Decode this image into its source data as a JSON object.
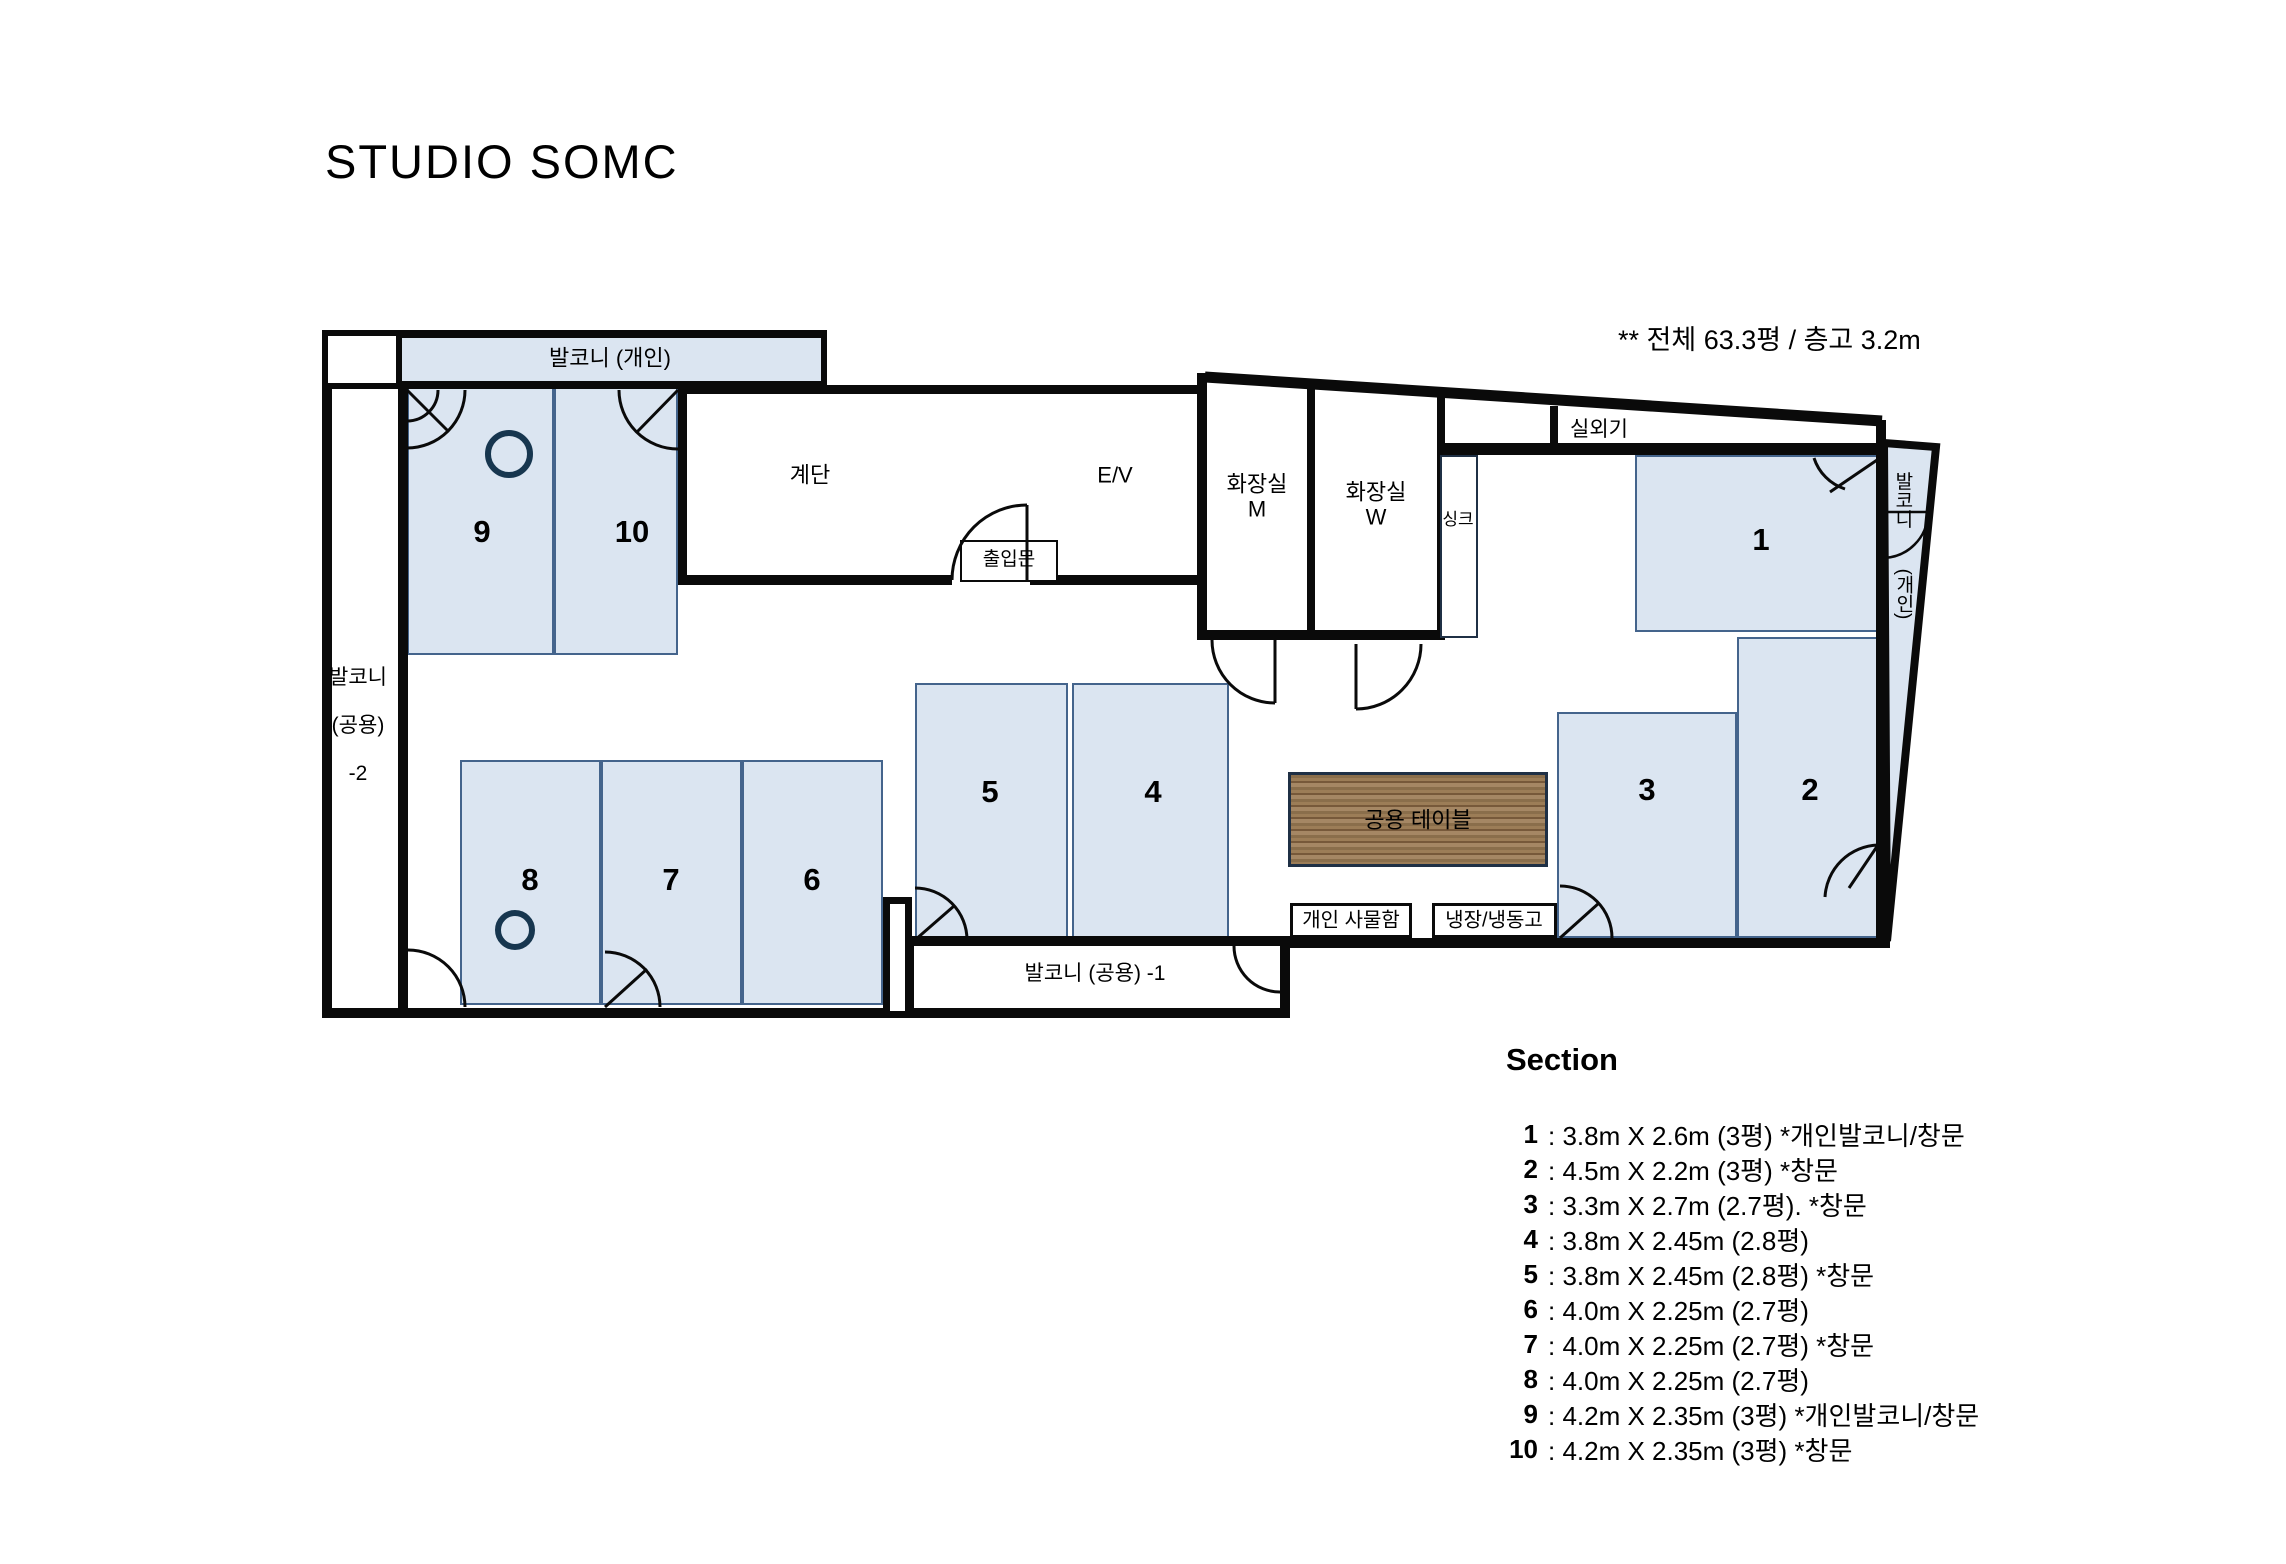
{
  "title": "STUDIO SOMC",
  "note": "** 전체 63.3평 / 층고 3.2m",
  "colors": {
    "room_fill": "#dbe5f1",
    "room_border": "#44648c",
    "wall": "#0a0a0a",
    "table_wood": "#8a6e4b",
    "column_circle": "#17364f"
  },
  "plan": {
    "balcony_top": "발코니 (개인)",
    "balcony_left_1": "발코니",
    "balcony_left_2": "(공용)",
    "balcony_left_3": "-2",
    "balcony_bottom": "발코니 (공용) -1",
    "balcony_right_1": "발코니",
    "balcony_right_2": "(개인)",
    "stairs": "계단",
    "elevator": "E/V",
    "entrance": "출입문",
    "toilet_m_1": "화장실",
    "toilet_m_2": "M",
    "toilet_w_1": "화장실",
    "toilet_w_2": "W",
    "sink": "싱크",
    "outdoor_unit": "실외기",
    "table": "공용 테이블",
    "lockers": "개인 사물함",
    "fridge": "냉장/냉동고",
    "rooms": [
      "1",
      "2",
      "3",
      "4",
      "5",
      "6",
      "7",
      "8",
      "9",
      "10"
    ]
  },
  "section": {
    "heading": "Section",
    "items": [
      {
        "num": "1",
        "text": ": 3.8m X 2.6m (3평)  *개인발코니/창문"
      },
      {
        "num": "2",
        "text": ": 4.5m X 2.2m (3평)  *창문"
      },
      {
        "num": "3",
        "text": ": 3.3m X 2.7m (2.7평). *창문"
      },
      {
        "num": "4",
        "text": ": 3.8m X 2.45m (2.8평)"
      },
      {
        "num": "5",
        "text": ": 3.8m X 2.45m (2.8평) *창문"
      },
      {
        "num": "6",
        "text": ": 4.0m X 2.25m (2.7평)"
      },
      {
        "num": "7",
        "text": ": 4.0m X 2.25m (2.7평) *창문"
      },
      {
        "num": "8",
        "text": ": 4.0m X 2.25m (2.7평)"
      },
      {
        "num": "9",
        "text": ": 4.2m X 2.35m (3평)  *개인발코니/창문"
      },
      {
        "num": "10",
        "text": ": 4.2m X 2.35m (3평) *창문"
      }
    ]
  }
}
